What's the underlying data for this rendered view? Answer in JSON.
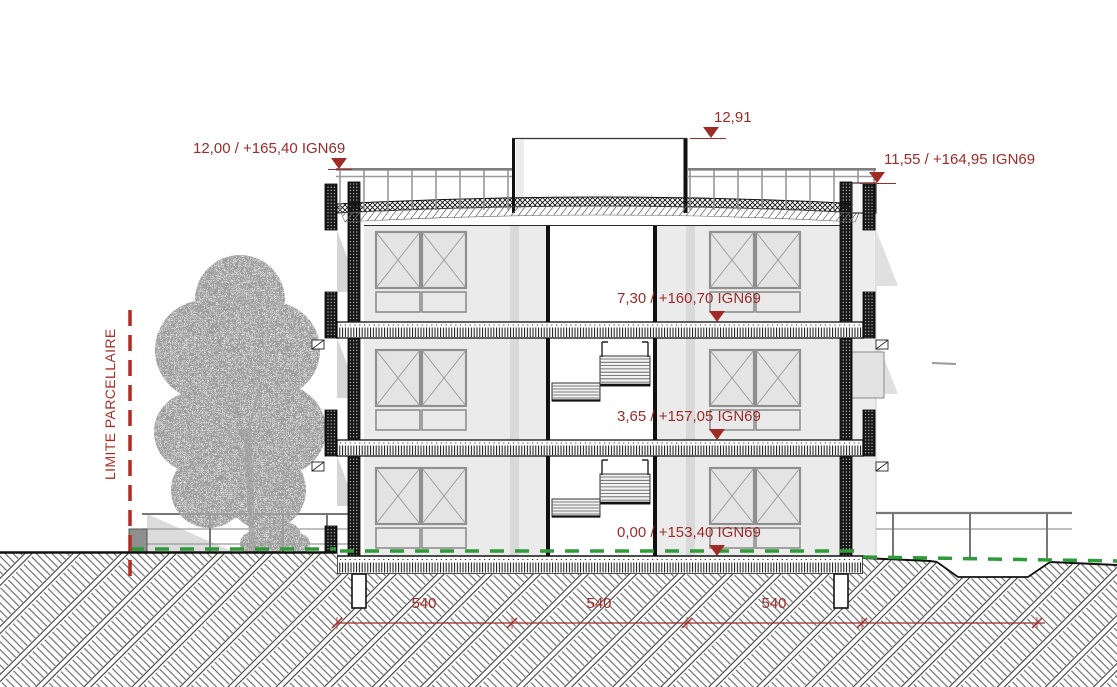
{
  "drawing": {
    "annotations": {
      "roof_left": "12,00 / +165,40 IGN69",
      "bulkhead": "12,91",
      "roof_right": "11,55 / +164,95 IGN69",
      "floor2": "7,30 / +160,70 IGN69",
      "floor1": "3,65 / +157,05 IGN69",
      "ground": "0,00 / +153,40 IGN69"
    },
    "boundary_label": "LIMITE PARCELLAIRE",
    "dimensions": [
      "540",
      "540",
      "540"
    ],
    "colors": {
      "annotation_red": "#9e2b28",
      "boundary_red": "#b02c24",
      "grass_green": "#2e9b38"
    }
  }
}
